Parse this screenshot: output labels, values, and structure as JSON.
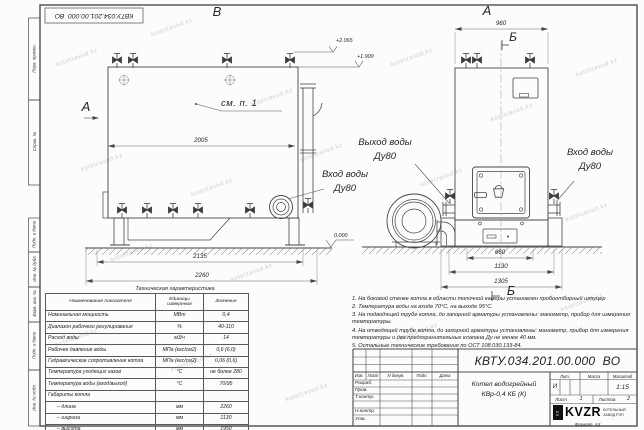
{
  "doc_number": "КВТУ.034.201.00.000  ВО",
  "watermark": "kotelzavod.kz",
  "margin_labels": [
    "Перв. примен.",
    "Справ. №",
    "Подп. и дата",
    "Инв. № дубл.",
    "Взам. инв. №",
    "Подп. и дата",
    "Инв. № подл."
  ],
  "views": {
    "top_view_label": "В",
    "front_view_label": "А",
    "side_view_label": "А",
    "section_label": "Б",
    "see_note": "см. п. 1",
    "elev_top": "+2.065",
    "elev_mid": "+1.900",
    "elev_zero": "0.000",
    "dims": {
      "d2005": "2005",
      "d2135": "2135",
      "d2260": "2260",
      "d960": "960",
      "d660": "660",
      "d1130": "1130",
      "d1305": "1305"
    },
    "labels": {
      "inlet_side_1": "Вход воды",
      "inlet_side_2": "Ду80",
      "outlet_1": "Выход воды",
      "outlet_2": "Ду80",
      "inlet_front_1": "Вход воды",
      "inlet_front_2": "Ду80"
    }
  },
  "spec_table": {
    "title": "Техническая характеристика",
    "headers": [
      "Наименование показателя",
      "Единицы измерения",
      "Значение"
    ],
    "rows": [
      {
        "name": "Номинальная мощность",
        "unit": "МВт",
        "value": "0,4"
      },
      {
        "name": "Диапазон рабочего регулирования",
        "unit": "%",
        "value": "40-110"
      },
      {
        "name": "Расход воды",
        "unit": "м3/ч",
        "value": "14"
      },
      {
        "name": "Рабочее давление воды",
        "unit": "МПа (кгс/см2)",
        "value": "0,6 (6,0)"
      },
      {
        "name": "Гидравлическое сопротивление котла",
        "unit": "МПа (кгс/см2)",
        "value": "0,06 (0,6)"
      },
      {
        "name": "Температура уходящих газов",
        "unit": "°С",
        "value": "не более 280"
      },
      {
        "name": "Температура воды (вход/выход)",
        "unit": "°С",
        "value": "70/95"
      },
      {
        "name": "Габариты котла",
        "unit": "",
        "value": ""
      },
      {
        "name": "– длина",
        "unit": "мм",
        "value": "2260"
      },
      {
        "name": "– ширина",
        "unit": "мм",
        "value": "1130"
      },
      {
        "name": "– высота",
        "unit": "мм",
        "value": "1950"
      }
    ]
  },
  "notes": [
    "1. На боковой стенке котла в области топочной камеры установлен пробоотборный штуцер",
    "2. Температура воды на входе 70°С, на выходе 95°С.",
    "3. На подводящей трубе котла, до запорной арматуры установлены: манометр, прибор для измерения температуры.",
    "4. На отводящей трубе котла, до запорной арматуры установлены: манометр, прибор для измерения температуры и два предохранительных клапана Ду не менее 40 мм.",
    "5. Остальные технические требования по ОСТ 108.030.133-84."
  ],
  "title_block": {
    "header_cols": [
      "Изм.",
      "Лист",
      "N докум.",
      "Подп.",
      "Дата"
    ],
    "sign_rows": [
      "Разраб.",
      "Пров.",
      "Т.контр.",
      "Н.контр.",
      "Утв."
    ],
    "product_1": "Котел водогрейный",
    "product_2": "КВр-0,4 КБ (К)",
    "lit_label": "Лит.",
    "mass_label": "Масса",
    "scale_label": "Масштаб",
    "lit_value": "И",
    "scale_value": "1:15",
    "sheet_label": "Лист",
    "sheet_value": "1",
    "sheets_label": "Листов",
    "sheets_value": "2",
    "logo_mark": "КЗ",
    "logo_text": "KVZR",
    "logo_sub1": "КОТЕЛЬНЫЙ",
    "logo_sub2": "ЗАВОД РЭП",
    "format_label": "Формат",
    "format_value": "А3"
  }
}
